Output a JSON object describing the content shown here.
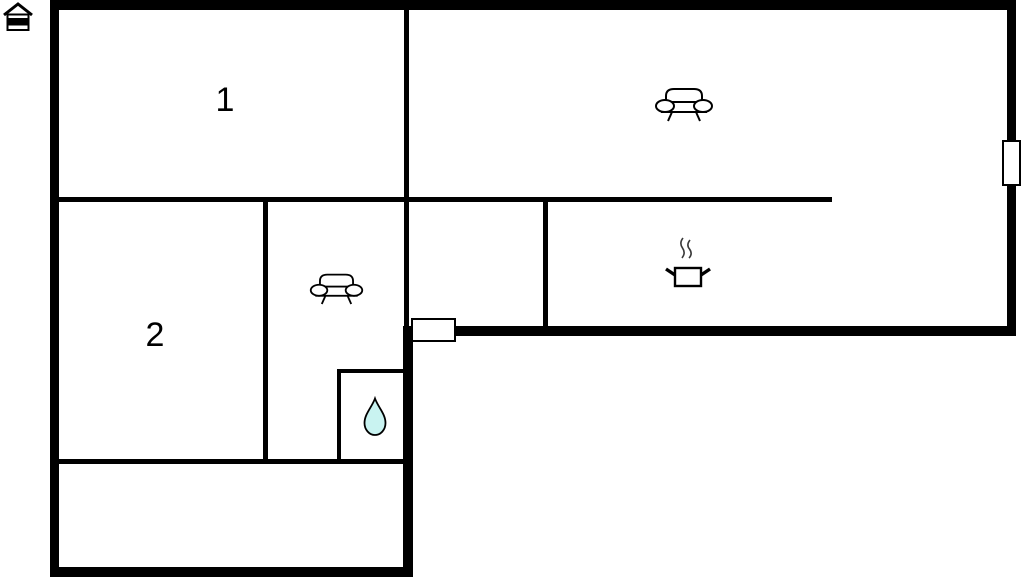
{
  "title": "Floor plan",
  "logo": {
    "name": "house-logo"
  },
  "floorplan": {
    "wall_color": "#000000",
    "background_color": "#ffffff",
    "drop_fill_color": "#c9f3f1",
    "rooms": [
      {
        "label": "1",
        "cx": 225,
        "cy": 100
      },
      {
        "label": "2",
        "cx": 155,
        "cy": 335
      }
    ],
    "icons": [
      {
        "name": "sofa-icon-living"
      },
      {
        "name": "sofa-icon-small-room"
      },
      {
        "name": "cooking-pot-icon"
      },
      {
        "name": "water-drop-icon"
      },
      {
        "name": "house-logo-icon"
      }
    ],
    "walls": [
      {
        "x": 50,
        "y": 0,
        "w": 966,
        "h": 10,
        "kind": "outer-top"
      },
      {
        "x": 50,
        "y": 0,
        "w": 9,
        "h": 577,
        "kind": "outer-left"
      },
      {
        "x": 1007,
        "y": 0,
        "w": 9,
        "h": 336,
        "kind": "outer-right"
      },
      {
        "x": 405,
        "y": 326,
        "w": 611,
        "h": 10,
        "kind": "thick-mid-horizontal"
      },
      {
        "x": 403,
        "y": 326,
        "w": 10,
        "h": 251,
        "kind": "thick-mid-vertical"
      },
      {
        "x": 50,
        "y": 567,
        "w": 363,
        "h": 10,
        "kind": "outer-bottom"
      },
      {
        "x": 404,
        "y": 0,
        "w": 5,
        "h": 330,
        "kind": "partition-room1-living"
      },
      {
        "x": 50,
        "y": 197,
        "w": 782,
        "h": 5,
        "kind": "partition-horizontal-main"
      },
      {
        "x": 263,
        "y": 197,
        "w": 5,
        "h": 267,
        "kind": "partition-room2-sofa"
      },
      {
        "x": 543,
        "y": 197,
        "w": 5,
        "h": 133,
        "kind": "partition-hall-kitchen"
      },
      {
        "x": 337,
        "y": 369,
        "w": 68,
        "h": 4,
        "kind": "bathroom-top"
      },
      {
        "x": 337,
        "y": 369,
        "w": 4,
        "h": 95,
        "kind": "bathroom-left"
      },
      {
        "x": 50,
        "y": 459,
        "w": 355,
        "h": 5,
        "kind": "partition-bottom-room"
      }
    ],
    "markers": [
      {
        "x": 1002,
        "y": 140,
        "w": 19,
        "h": 46,
        "kind": "window-right-wall"
      },
      {
        "x": 411,
        "y": 318,
        "w": 45,
        "h": 24,
        "kind": "door-mid-wall"
      }
    ]
  }
}
